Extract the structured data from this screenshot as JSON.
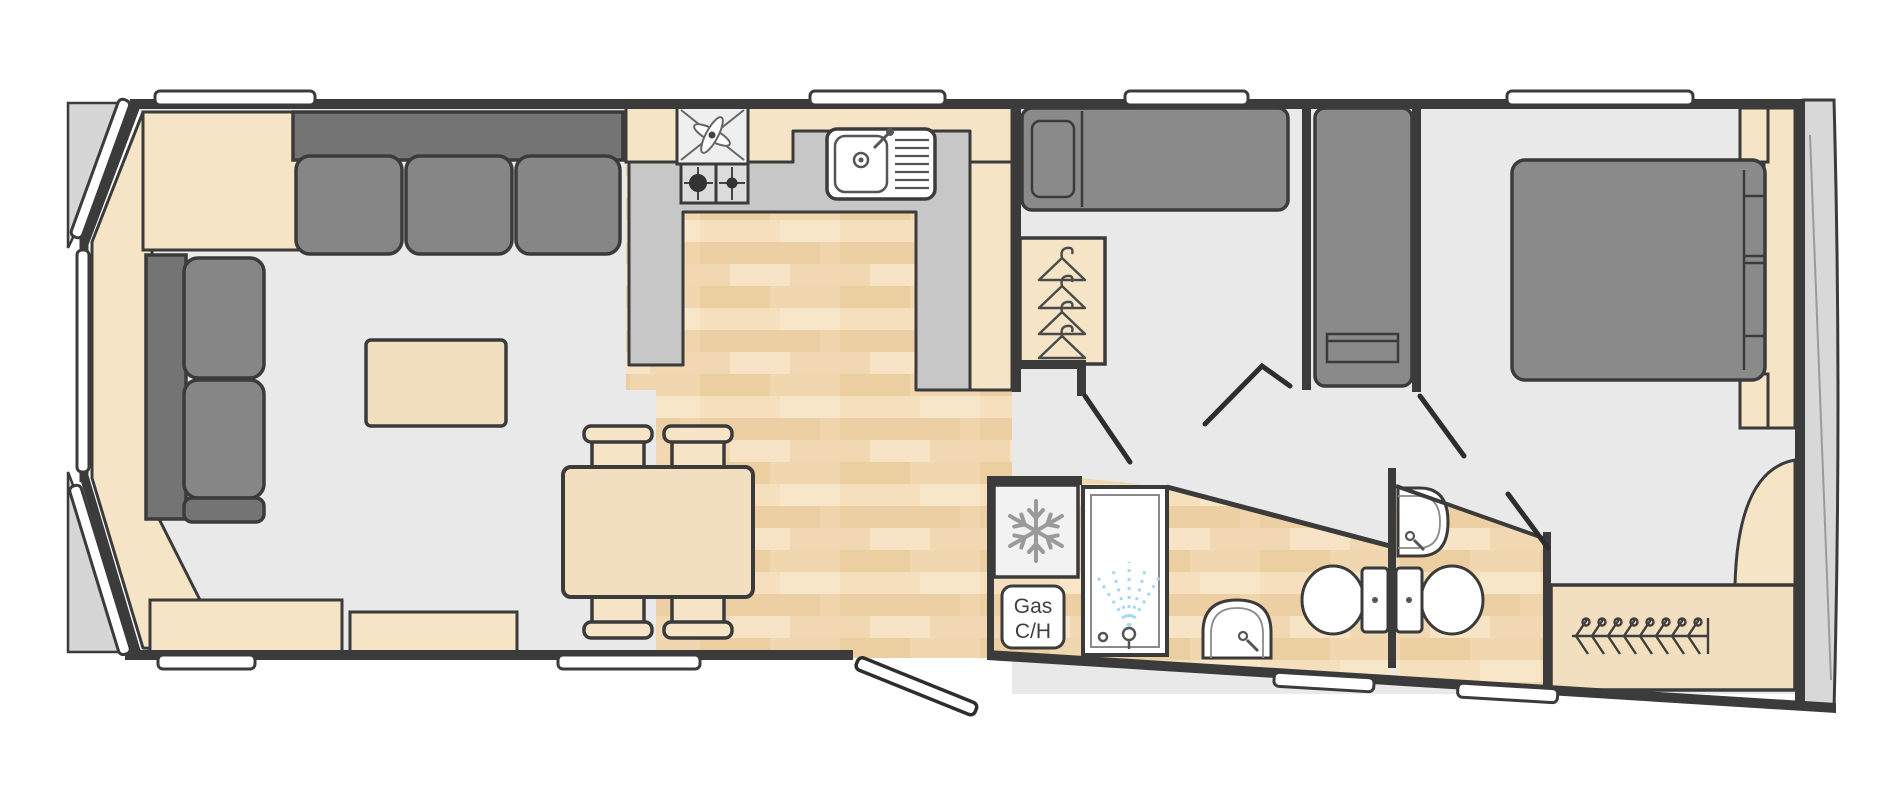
{
  "floor_plan": {
    "type": "static-caravan-floor-plan",
    "boiler_label": {
      "line1": "Gas",
      "line2": "C/H"
    },
    "palette": {
      "wall": "#3b3b3b",
      "carpet": "#e9e9e9",
      "wood": "#f0d5ac",
      "wood_light": "#f6e2c2",
      "wood_dark": "#ebcfa0",
      "cream_furniture": "#f5e4c6",
      "gray_furniture": "#8a8a8a",
      "gray_furniture_dark": "#747474",
      "counter_gray": "#c7c7c7",
      "appliance_gray": "#efefef",
      "fixture_white": "#ffffff",
      "spray_blue": "#a5d8f0",
      "exterior_gray": "#d8d8d8",
      "icon_gray": "#9a9a9a"
    },
    "icons": [
      "extractor-fan-icon",
      "gas-hob-icon",
      "sink-drainer-icon",
      "snowflake-fridge-icon",
      "gas-central-heating-label",
      "shower-spray-icon",
      "washbasin-icon",
      "toilet-icon",
      "coat-hanger-icon",
      "hanging-rail-icon"
    ],
    "counts": {
      "top_windows": 4,
      "bottom_windows": 4,
      "bay_windows": 3,
      "wardrobe_hangers": 4,
      "rail_hangers": 8,
      "dining_chairs": 4,
      "single_beds": 2,
      "double_beds": 1,
      "toilets": 2,
      "basins": 3
    }
  }
}
